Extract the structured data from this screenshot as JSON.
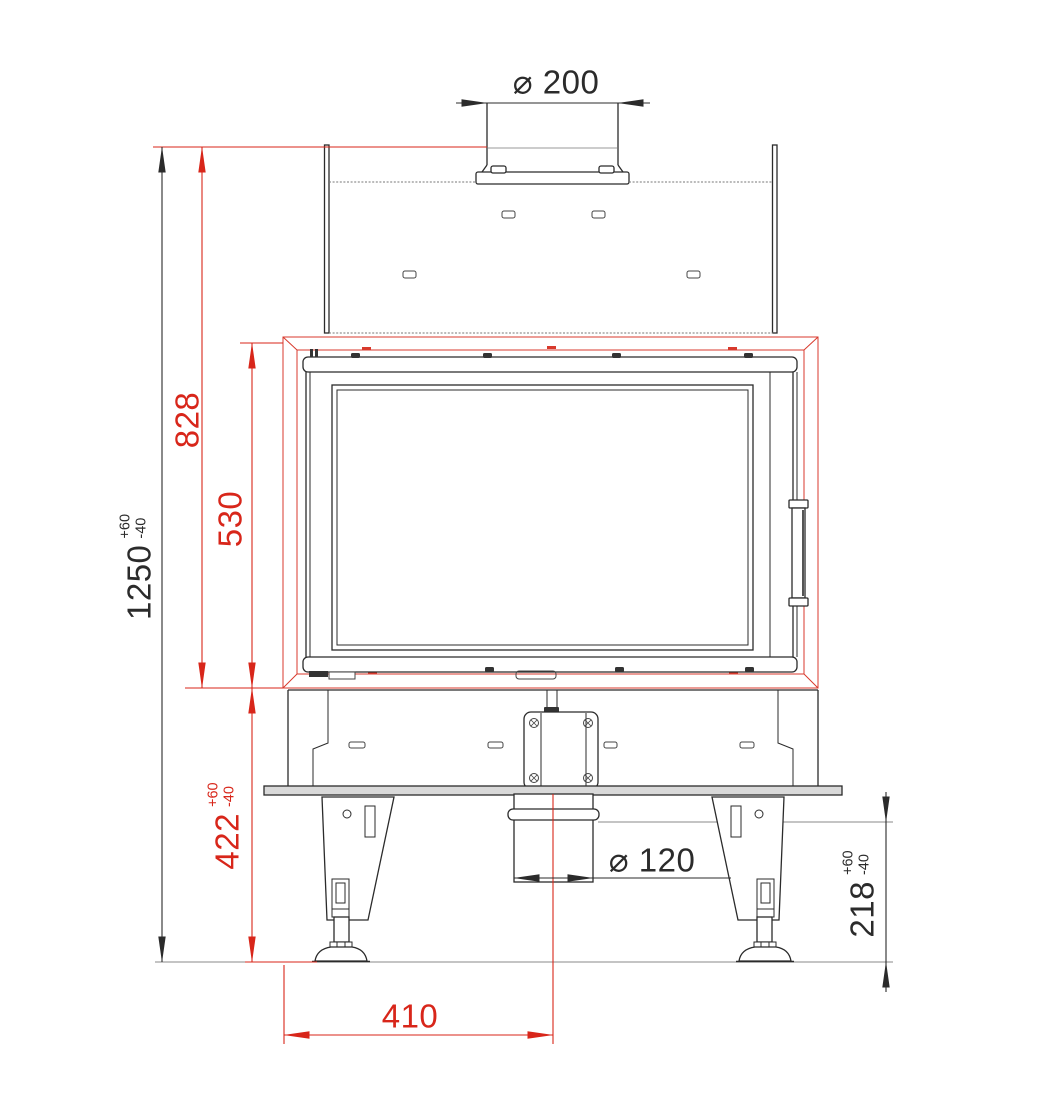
{
  "drawing": {
    "title": "fireplace-insert-front-view-dimension-drawing",
    "colors": {
      "dimension_red": "#d8261a",
      "line_black": "#2b2b2b"
    },
    "dimensions": {
      "flue_diameter": {
        "label": "⌀ 200"
      },
      "total_height": {
        "value": "1250",
        "tol_plus": "+60",
        "tol_minus": "-40"
      },
      "body_height": {
        "value": "828"
      },
      "door_frame_height": {
        "value": "530"
      },
      "base_section_height": {
        "value": "422",
        "tol_plus": "+60",
        "tol_minus": "-40"
      },
      "air_intake_height": {
        "value": "218",
        "tol_plus": "+60",
        "tol_minus": "-40"
      },
      "air_intake_diameter": {
        "label": "⌀ 120"
      },
      "air_intake_offset": {
        "value": "410"
      }
    }
  }
}
